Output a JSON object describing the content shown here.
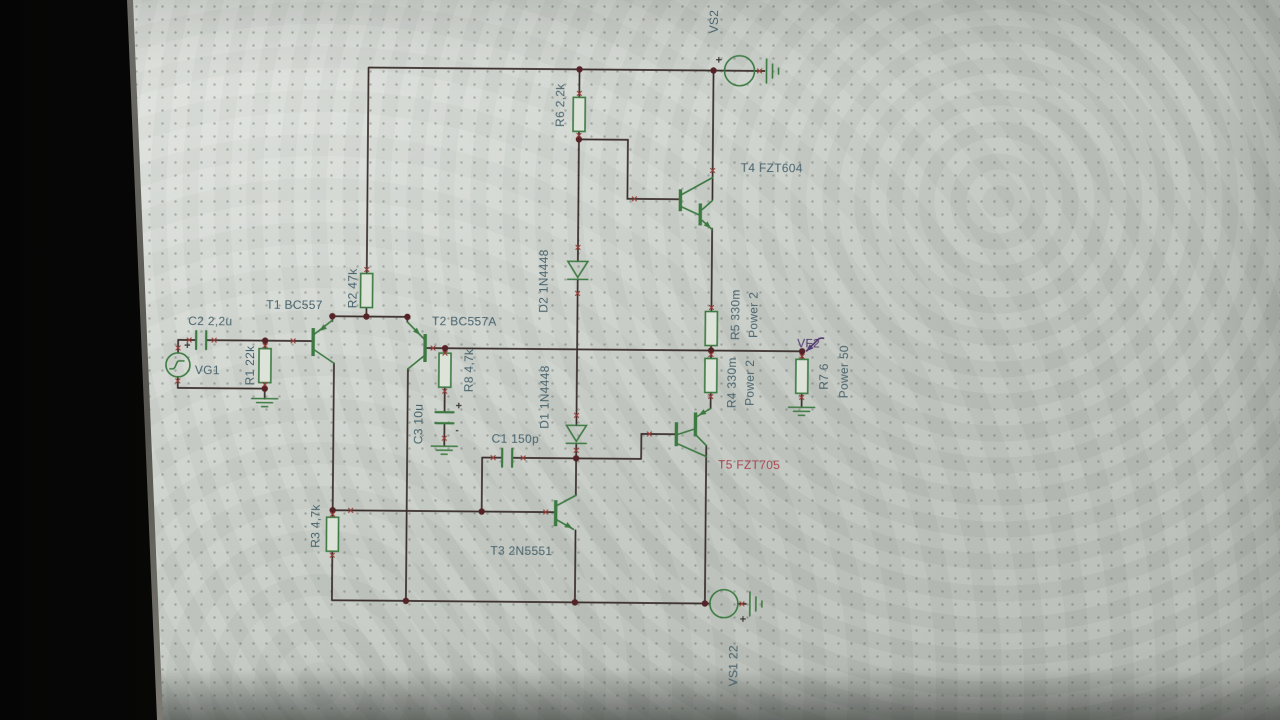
{
  "colors": {
    "screen_bg": "#c7ccc6",
    "wire": "#3a2e2b",
    "symbol_green": "#3c7a42",
    "label_teal": "#47626c",
    "highlight_red": "#a84450",
    "probe_purple": "#533a72",
    "junction_dot": "#552327"
  },
  "components": {
    "vg1": {
      "label": "VG1",
      "plus": "+"
    },
    "c2": {
      "label": "C2 2,2u"
    },
    "r1": {
      "label": "R1 22k"
    },
    "t1": {
      "label": "T1 BC557"
    },
    "r2": {
      "label": "R2 47k"
    },
    "t2": {
      "label": "T2 BC557A"
    },
    "r8": {
      "label": "R8 4,7k"
    },
    "c3": {
      "label": "C3 10u",
      "plus": "+",
      "minus": "-"
    },
    "r3": {
      "label": "R3 4,7k"
    },
    "c1": {
      "label": "C1 150p"
    },
    "t3": {
      "label": "T3 2N5551"
    },
    "d1": {
      "label": "D1 1N4448"
    },
    "d2": {
      "label": "D2 1N4448"
    },
    "r6": {
      "label": "R6 2,2k"
    },
    "t4": {
      "label": "T4 FZT604"
    },
    "t5": {
      "label": "T5 FZT705"
    },
    "r5": {
      "label": "R5 330m",
      "power": "Power 2"
    },
    "r4": {
      "label": "R4 330m",
      "power": "Power 2"
    },
    "r7": {
      "label": "R7 6",
      "power": "Power 50"
    },
    "vf2": {
      "label": "VF2"
    },
    "vs1": {
      "label": "VS1 22",
      "plus": "+"
    },
    "vs2": {
      "label": "VS2",
      "plus": "+"
    }
  }
}
